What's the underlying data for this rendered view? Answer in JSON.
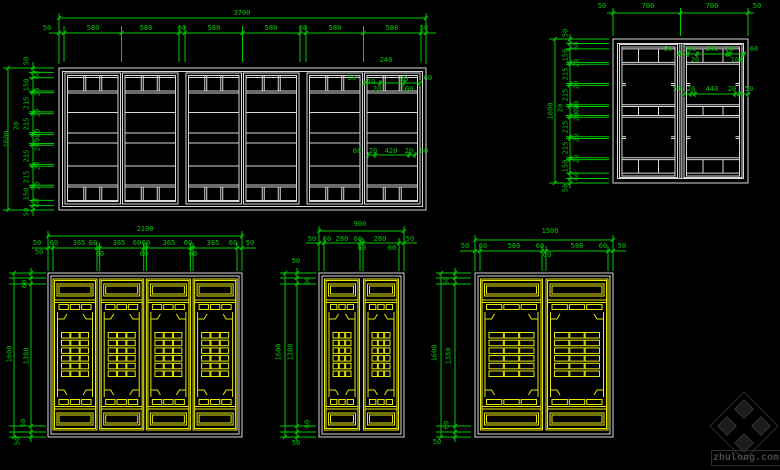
{
  "colors": {
    "background": "#000000",
    "dimension": "#00c800",
    "white_lines": "#d8d8d8",
    "yellow_lines": "#e8e800",
    "watermark_line": "#2c2c2c",
    "watermark_fill": "#1b1b1b",
    "watermark_text": "#464646"
  },
  "watermark": {
    "text": "zhulong.com",
    "logo": "pinwheel-diamond-logo"
  },
  "drawings": [
    {
      "id": "top-left-window-elevation",
      "labels": [
        {
          "t": "3700",
          "x": 242,
          "y": 14
        },
        {
          "t": "50",
          "x": 47,
          "y": 29
        },
        {
          "t": "580",
          "x": 93,
          "y": 29
        },
        {
          "t": "580",
          "x": 146,
          "y": 29
        },
        {
          "t": "60",
          "x": 182,
          "y": 29
        },
        {
          "t": "580",
          "x": 214,
          "y": 29
        },
        {
          "t": "580",
          "x": 271,
          "y": 29
        },
        {
          "t": "60",
          "x": 303,
          "y": 29
        },
        {
          "t": "580",
          "x": 335,
          "y": 29
        },
        {
          "t": "580",
          "x": 392,
          "y": 29
        },
        {
          "t": "50",
          "x": 424,
          "y": 29
        },
        {
          "t": "1600",
          "x": 7,
          "y": 139,
          "r": 1
        },
        {
          "t": "20",
          "x": 17,
          "y": 126,
          "r": 1
        },
        {
          "t": "50",
          "x": 27,
          "y": 61,
          "r": 1
        },
        {
          "t": "60",
          "x": 38,
          "y": 75,
          "r": 1
        },
        {
          "t": "150",
          "x": 27,
          "y": 85,
          "r": 1
        },
        {
          "t": "20",
          "x": 38,
          "y": 92,
          "r": 1
        },
        {
          "t": "215",
          "x": 27,
          "y": 103,
          "r": 1
        },
        {
          "t": "20",
          "x": 38,
          "y": 113,
          "r": 1
        },
        {
          "t": "215",
          "x": 27,
          "y": 124,
          "r": 1
        },
        {
          "t": "20",
          "x": 38,
          "y": 133,
          "r": 1
        },
        {
          "t": "100",
          "x": 38,
          "y": 140,
          "r": 1
        },
        {
          "t": "20",
          "x": 38,
          "y": 147,
          "r": 1
        },
        {
          "t": "215",
          "x": 27,
          "y": 156,
          "r": 1
        },
        {
          "t": "20",
          "x": 38,
          "y": 166,
          "r": 1
        },
        {
          "t": "215",
          "x": 27,
          "y": 177,
          "r": 1
        },
        {
          "t": "20",
          "x": 38,
          "y": 186,
          "r": 1
        },
        {
          "t": "150",
          "x": 27,
          "y": 194,
          "r": 1
        },
        {
          "t": "60",
          "x": 38,
          "y": 203,
          "r": 1
        },
        {
          "t": "50",
          "x": 27,
          "y": 212,
          "r": 1
        },
        {
          "t": "240",
          "x": 386,
          "y": 61
        },
        {
          "t": "50",
          "x": 352,
          "y": 79
        },
        {
          "t": "60",
          "x": 371,
          "y": 83
        },
        {
          "t": "30",
          "x": 404,
          "y": 80
        },
        {
          "t": "60",
          "x": 428,
          "y": 79
        },
        {
          "t": "20",
          "x": 377,
          "y": 90
        },
        {
          "t": "100",
          "x": 407,
          "y": 90
        },
        {
          "t": "60",
          "x": 357,
          "y": 152
        },
        {
          "t": "20",
          "x": 373,
          "y": 152
        },
        {
          "t": "420",
          "x": 391,
          "y": 152
        },
        {
          "t": "20",
          "x": 409,
          "y": 152
        },
        {
          "t": "60",
          "x": 424,
          "y": 152
        }
      ]
    },
    {
      "id": "top-right-window-elevation",
      "labels": [
        {
          "t": "50",
          "x": 602,
          "y": 7
        },
        {
          "t": "700",
          "x": 648,
          "y": 7
        },
        {
          "t": "700",
          "x": 712,
          "y": 7
        },
        {
          "t": "50",
          "x": 757,
          "y": 7
        },
        {
          "t": "1600",
          "x": 551,
          "y": 111,
          "r": 1
        },
        {
          "t": "20",
          "x": 561,
          "y": 108,
          "r": 1
        },
        {
          "t": "50",
          "x": 566,
          "y": 33,
          "r": 1
        },
        {
          "t": "60",
          "x": 577,
          "y": 46,
          "r": 1
        },
        {
          "t": "150",
          "x": 566,
          "y": 55,
          "r": 1
        },
        {
          "t": "20",
          "x": 577,
          "y": 63,
          "r": 1
        },
        {
          "t": "215",
          "x": 566,
          "y": 74,
          "r": 1
        },
        {
          "t": "20",
          "x": 577,
          "y": 85,
          "r": 1
        },
        {
          "t": "215",
          "x": 566,
          "y": 95,
          "r": 1
        },
        {
          "t": "20",
          "x": 577,
          "y": 105,
          "r": 1
        },
        {
          "t": "100",
          "x": 577,
          "y": 111,
          "r": 1
        },
        {
          "t": "20",
          "x": 577,
          "y": 117,
          "r": 1
        },
        {
          "t": "215",
          "x": 566,
          "y": 127,
          "r": 1
        },
        {
          "t": "20",
          "x": 577,
          "y": 138,
          "r": 1
        },
        {
          "t": "215",
          "x": 566,
          "y": 148,
          "r": 1
        },
        {
          "t": "20",
          "x": 577,
          "y": 159,
          "r": 1
        },
        {
          "t": "150",
          "x": 566,
          "y": 166,
          "r": 1
        },
        {
          "t": "60",
          "x": 577,
          "y": 176,
          "r": 1
        },
        {
          "t": "50",
          "x": 566,
          "y": 188,
          "r": 1
        },
        {
          "t": "50",
          "x": 668,
          "y": 50
        },
        {
          "t": "100",
          "x": 690,
          "y": 50
        },
        {
          "t": "340",
          "x": 712,
          "y": 50
        },
        {
          "t": "30",
          "x": 729,
          "y": 50
        },
        {
          "t": "60",
          "x": 754,
          "y": 50
        },
        {
          "t": "20",
          "x": 695,
          "y": 61
        },
        {
          "t": "100",
          "x": 737,
          "y": 61
        },
        {
          "t": "50",
          "x": 677,
          "y": 90
        },
        {
          "t": "20",
          "x": 691,
          "y": 90
        },
        {
          "t": "440",
          "x": 712,
          "y": 90
        },
        {
          "t": "20",
          "x": 732,
          "y": 90
        },
        {
          "t": "50",
          "x": 749,
          "y": 90
        }
      ]
    },
    {
      "id": "bottom-left-lattice-door-elevation",
      "labels": [
        {
          "t": "2100",
          "x": 145,
          "y": 230
        },
        {
          "t": "50",
          "x": 37,
          "y": 244
        },
        {
          "t": "60",
          "x": 54,
          "y": 244
        },
        {
          "t": "365",
          "x": 79,
          "y": 244
        },
        {
          "t": "60",
          "x": 93,
          "y": 244
        },
        {
          "t": "365",
          "x": 119,
          "y": 244
        },
        {
          "t": "60",
          "x": 137,
          "y": 244
        },
        {
          "t": "60",
          "x": 146,
          "y": 244
        },
        {
          "t": "365",
          "x": 169,
          "y": 244
        },
        {
          "t": "60",
          "x": 188,
          "y": 244
        },
        {
          "t": "365",
          "x": 213,
          "y": 244
        },
        {
          "t": "60",
          "x": 233,
          "y": 244
        },
        {
          "t": "50",
          "x": 250,
          "y": 244
        },
        {
          "t": "60",
          "x": 100,
          "y": 255
        },
        {
          "t": "60",
          "x": 144,
          "y": 255
        },
        {
          "t": "60",
          "x": 193,
          "y": 255
        },
        {
          "t": "50",
          "x": 39,
          "y": 253
        },
        {
          "t": "60",
          "x": 25,
          "y": 284,
          "r": 1
        },
        {
          "t": "1600",
          "x": 10,
          "y": 354,
          "r": 1
        },
        {
          "t": "1380",
          "x": 27,
          "y": 356,
          "r": 1
        },
        {
          "t": "60",
          "x": 24,
          "y": 423,
          "r": 1
        },
        {
          "t": "50",
          "x": 18,
          "y": 441,
          "r": 1
        }
      ]
    },
    {
      "id": "bottom-middle-lattice-door-elevation",
      "labels": [
        {
          "t": "900",
          "x": 360,
          "y": 225
        },
        {
          "t": "50",
          "x": 312,
          "y": 240
        },
        {
          "t": "60",
          "x": 327,
          "y": 240
        },
        {
          "t": "280",
          "x": 342,
          "y": 240
        },
        {
          "t": "60",
          "x": 358,
          "y": 240
        },
        {
          "t": "280",
          "x": 380,
          "y": 240
        },
        {
          "t": "50",
          "x": 410,
          "y": 240
        },
        {
          "t": "60",
          "x": 362,
          "y": 249
        },
        {
          "t": "60",
          "x": 392,
          "y": 249
        },
        {
          "t": "50",
          "x": 296,
          "y": 262
        },
        {
          "t": "60",
          "x": 308,
          "y": 281,
          "r": 1
        },
        {
          "t": "1600",
          "x": 279,
          "y": 352,
          "r": 1
        },
        {
          "t": "1380",
          "x": 291,
          "y": 352,
          "r": 1
        },
        {
          "t": "60",
          "x": 308,
          "y": 424,
          "r": 1
        },
        {
          "t": "50",
          "x": 296,
          "y": 444
        }
      ]
    },
    {
      "id": "bottom-right-lattice-door-elevation",
      "labels": [
        {
          "t": "1500",
          "x": 550,
          "y": 232
        },
        {
          "t": "50",
          "x": 465,
          "y": 247
        },
        {
          "t": "60",
          "x": 483,
          "y": 247
        },
        {
          "t": "580",
          "x": 514,
          "y": 247
        },
        {
          "t": "60",
          "x": 540,
          "y": 247
        },
        {
          "t": "580",
          "x": 577,
          "y": 247
        },
        {
          "t": "60",
          "x": 603,
          "y": 247
        },
        {
          "t": "50",
          "x": 622,
          "y": 247
        },
        {
          "t": "60",
          "x": 547,
          "y": 256
        },
        {
          "t": "60",
          "x": 447,
          "y": 281,
          "r": 1
        },
        {
          "t": "1600",
          "x": 435,
          "y": 353,
          "r": 1
        },
        {
          "t": "1380",
          "x": 449,
          "y": 356,
          "r": 1
        },
        {
          "t": "60",
          "x": 447,
          "y": 425,
          "r": 1
        },
        {
          "t": "50",
          "x": 437,
          "y": 443
        }
      ]
    }
  ]
}
